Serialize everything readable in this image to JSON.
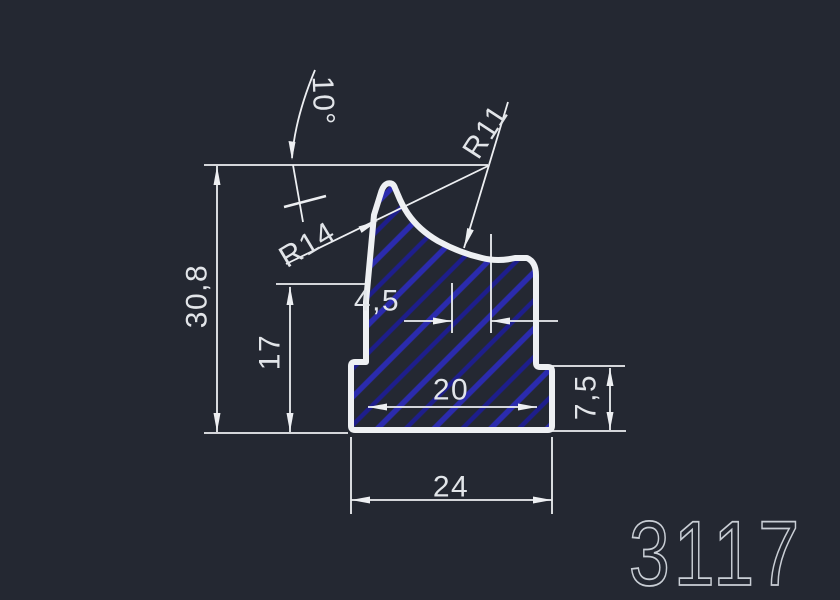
{
  "drawing": {
    "part_number": "3117",
    "labels": {
      "angle": "10°",
      "radius_top": "R14",
      "radius_right": "R11",
      "total_height": "30,8",
      "body_height": "17",
      "top_offset": "4,5",
      "body_width": "20",
      "base_height": "7,5",
      "base_width": "24"
    },
    "colors": {
      "background": "#242832",
      "outline": "#eef0f3",
      "hatch_primary": "#2b2bae",
      "hatch_secondary": "#1e1e8c",
      "dimension_lines": "#edeff2",
      "dimension_text": "#e2e5e9",
      "part_number_text": "#c9ced5"
    }
  }
}
